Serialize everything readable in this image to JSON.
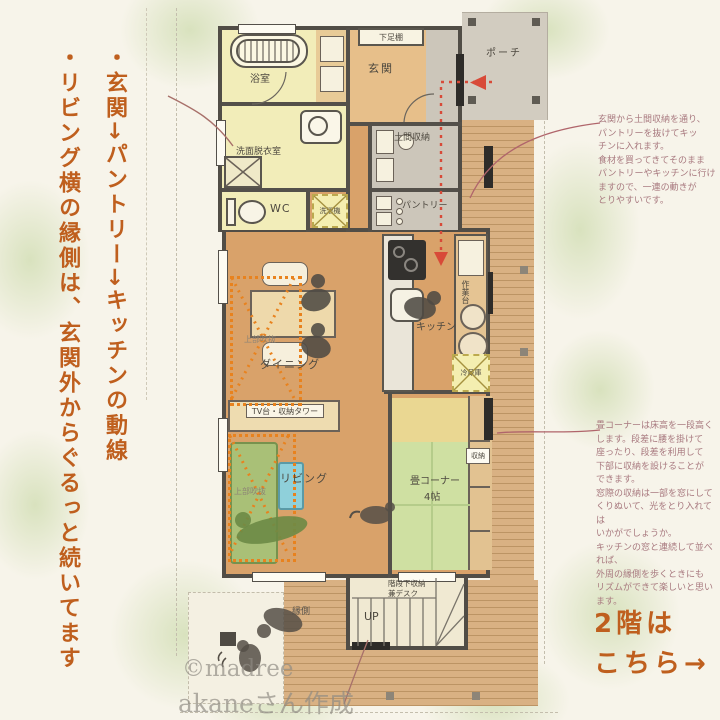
{
  "notes_left": {
    "note1": "・玄関→パントリー→キッチンの動線",
    "note2": "・リビング横の縁側は、玄関外からぐるっと続いてます"
  },
  "annotations": {
    "entrance_flow": "玄関から土間収納を通り、\nパントリーを抜けてキッ\nチンに入れます。\n食材を買ってきてそのまま\nパントリーやキッチンに行け\nますので、一連の動きが\nとりやすいです。",
    "tatami": "畳コーナーは床高を一段高く\nします。段差に腰を掛けて\n座ったり、段差を利用して\n下部に収納を設けることが\nできます。\n窓際の収納は一部を窓にして\nくりぬいて、光をとり入れては\nいかがでしょうか。\nキッチンの窓と連続して並べれば、\n外周の縁側を歩くときにも\nリズムができて楽しいと思います。"
  },
  "second_floor": {
    "line1": "2階は",
    "line2": "こちら→"
  },
  "credits": {
    "brand": "©madree",
    "author": "akaneさん作成"
  },
  "plan": {
    "bath": "浴室",
    "washroom": "洗面脱衣室",
    "wc": "WC",
    "washer": "洗濯機",
    "entrance": "玄関",
    "shoe_shelf": "下足棚",
    "porch": "ポーチ",
    "doma_storage": "土間収納",
    "pantry": "パントリー",
    "kitchen": "キッチン",
    "work_counter": "作業台",
    "fridge": "冷蔵庫",
    "dining": "ダイニング",
    "void_dining": "上部吹抜",
    "void_living": "上部吹抜",
    "tv_stand": "TV台・収納タワー",
    "living": "リビング",
    "tatami_label": "畳コーナー",
    "tatami_size": "4帖",
    "storage": "収納",
    "stairs_up": "UP",
    "stairs_desk": "階段下収納\n兼デスク",
    "engawa": "縁側"
  },
  "colors": {
    "accent_orange": "#bf5f1e",
    "annotation_pink": "#a8797f",
    "flow_red": "#d84a38",
    "void_orange": "#e8821e",
    "wall": "#54504a",
    "floor_wood": "#d9a26a",
    "tatami_green": "#cfe0a2",
    "pale_yellow": "#f2edb9",
    "deck_wood": "#d9b183"
  }
}
